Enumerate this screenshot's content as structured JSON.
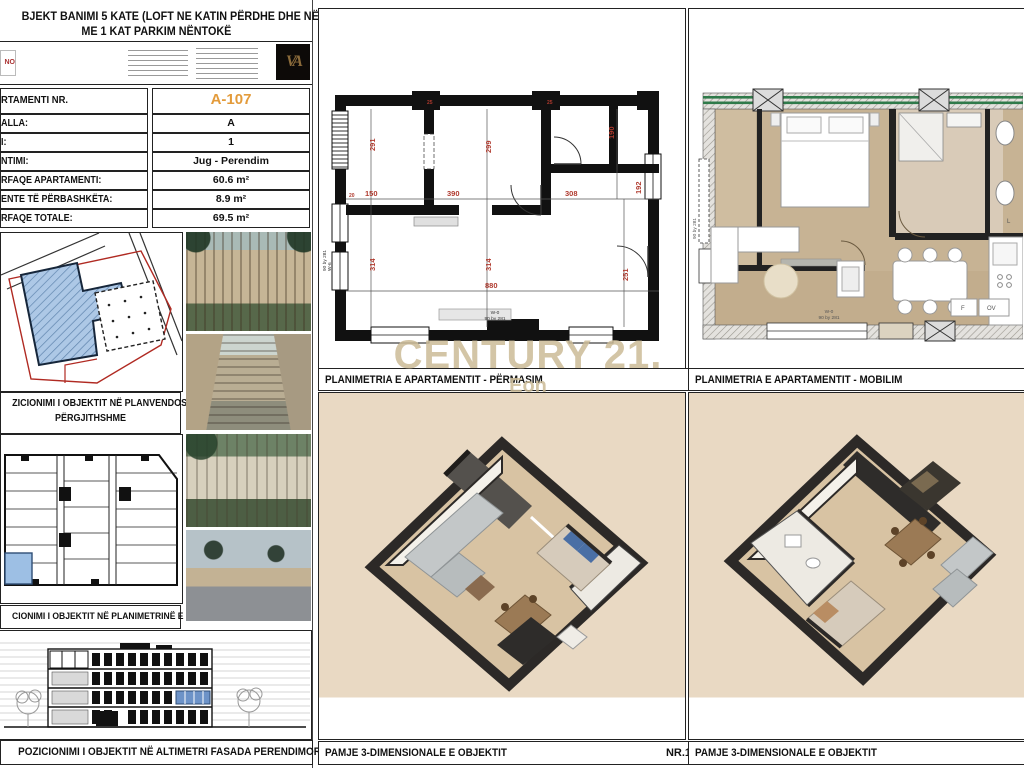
{
  "sheet": {
    "title_line1": "BJEKT BANIMI 5 KATE (LOFT NE KATIN PËRDHE DHE NË KATIN E FUNDIT)",
    "title_line2": "ME 1 KAT PARKIM NËNTOKË"
  },
  "logos": {
    "left_fragment": "NO",
    "monogram": "VA"
  },
  "info_table": {
    "rows": [
      {
        "label": "RTAMENTI NR.",
        "value": "A-107"
      },
      {
        "label": "ALLA:",
        "value": "A"
      },
      {
        "label": "I:",
        "value": "1"
      },
      {
        "label": "NTIMI:",
        "value": "Jug - Perendim"
      },
      {
        "label": "RFAQE APARTAMENTI:",
        "value": "60.6 m²"
      },
      {
        "label": "ENTE TË PËRBASHKËTA:",
        "value": "8.9 m²"
      },
      {
        "label": "RFAQE TOTALE:",
        "value": "69.5 m²"
      }
    ],
    "highlight_color": "#e39b3b"
  },
  "captions": {
    "site_plan_1": "ZICIONIMI I OBJEKTIT NË PLANVENDOSJEN E",
    "site_plan_2": "PËRGJITHSHME",
    "floor_plan": "CIONIMI I OBJEKTIT NË PLANIMETRINË E KATIT",
    "elevation": "POZICIONIMI I OBJEKTIT NË ALTIMETRI FASADA  PERENDIMORE",
    "plan_dimensioned": "PLANIMETRIA E APARTAMENTIT - PËRMASIM",
    "plan_furnished": "PLANIMETRIA E APARTAMENTIT - MOBILIM",
    "view3d_1": "PAMJE 3-DIMENSIONALE E OBJEKTIT",
    "view3d_1_nr": "NR.1",
    "view3d_2": "PAMJE 3-DIMENSIONALE E OBJEKTIT"
  },
  "watermark": {
    "brand": "CENTURY 21.",
    "sub": "Eon"
  },
  "plan": {
    "dims": {
      "room1_h": "291",
      "living_h": "299",
      "bath_h": "190",
      "entry_w": "150",
      "living_w": "390",
      "hall_w": "308",
      "room1_low_h": "314",
      "living_low_h": "314",
      "total_w": "880",
      "right_low_h": "251",
      "hall_h": "192"
    },
    "ticks": [
      "25",
      "25",
      "20"
    ],
    "window_left_code": "W-6",
    "window_left_size": "90 by 281",
    "window_bottom_code": "W-0",
    "window_bottom_size": "90 by 281"
  },
  "furnished": {
    "fridge": "F",
    "oven": "OV",
    "laundry": "L",
    "window_code": "W-0",
    "window_size": "90 by 281",
    "window_left_size": "90 by 281"
  }
}
